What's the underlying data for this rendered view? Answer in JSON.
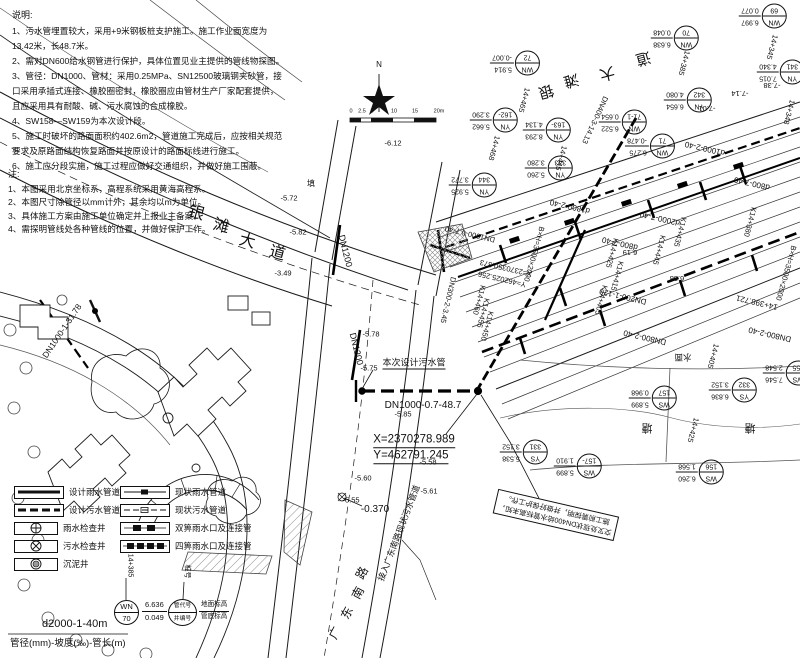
{
  "notes1": {
    "title": "说明:",
    "lines": [
      "1、污水管埋置较大，采用+9米钢板桩支护施工。施工作业面宽度为13.42米，长48.7米。",
      "2、需对DN600给水钢管进行保护，具体位置见业主提供的管线物探图。",
      "3、管径：DN1000、管材：采用0.25MPa、SN12500玻璃钢夹砂管，接口采用承插式连接、橡胶圈密封，橡胶圈应由管材生产厂家配套提供，且应采用具有耐酸、碱、污水腐蚀的合成橡胶。",
      "4、SW158—SW159为本次设计段。",
      "5、施工时破坏的路面面积约402.6m2，管道施工完成后，应按相关规范要求及原路面结构恢复路面并按原设计的路面标线进行施工。",
      "6、施工应分段实施，施工过程应做好交通组织，并做好施工围蔽。"
    ]
  },
  "notes2": {
    "title": "注:",
    "lines": [
      "1、本图采用北京坐标系，高程系统采用黄海高程系。",
      "2、本图尺寸除管径以mm计外，其余均以m为单位。",
      "3、具体施工方案由施工单位确定并上报业主备案。",
      "4、需探明管线处各种管线的位置，并做好保护工作。"
    ]
  },
  "legend": {
    "left": [
      {
        "label": "设计雨水管道"
      },
      {
        "label": "设计污水管道"
      },
      {
        "label": "雨水检查井"
      },
      {
        "label": "污水检查井"
      },
      {
        "label": "沉泥井"
      }
    ],
    "right": [
      {
        "label": "现状雨水管道"
      },
      {
        "label": "现状污水管道"
      },
      {
        "label": "双箅雨水口及连接管"
      },
      {
        "label": "四箅雨水口及连接管"
      }
    ]
  },
  "example": {
    "chainage": "14+385",
    "code": "WN",
    "num": "70",
    "v1": "6.636",
    "v2": "0.049",
    "chainage2_label": "桩号",
    "code_label": "管代号",
    "num_label": "井编号",
    "v1_label": "地面标高",
    "v2_label": "管底标高"
  },
  "footer": {
    "spec": "d2000-1-40m",
    "caption": "管径(mm)-坡度(‰)-管长(m)"
  },
  "note_box": {
    "line1": "交叉处现状DN400给水管标高未知，",
    "line2": "施工前需探明，并做好保护工作。"
  },
  "annotations": [
    {
      "t": "银",
      "x": 196,
      "y": 214,
      "r": 15,
      "s": 16
    },
    {
      "t": "滩",
      "x": 221,
      "y": 227,
      "r": 15,
      "s": 16
    },
    {
      "t": "大",
      "x": 247,
      "y": 242,
      "r": 15,
      "s": 16
    },
    {
      "t": "道",
      "x": 277,
      "y": 254,
      "r": 15,
      "s": 16
    },
    {
      "t": "银",
      "x": 546,
      "y": 91,
      "r": 165,
      "s": 15
    },
    {
      "t": "滩",
      "x": 571,
      "y": 80,
      "r": 165,
      "s": 15
    },
    {
      "t": "大",
      "x": 607,
      "y": 73,
      "r": 165,
      "s": 15
    },
    {
      "t": "道",
      "x": 643,
      "y": 58,
      "r": 165,
      "s": 15
    },
    {
      "t": "广",
      "x": 335,
      "y": 633,
      "r": -62,
      "s": 12
    },
    {
      "t": "东",
      "x": 347,
      "y": 613,
      "r": -62,
      "s": 12
    },
    {
      "t": "南",
      "x": 358,
      "y": 593,
      "r": -62,
      "s": 12
    },
    {
      "t": "路",
      "x": 362,
      "y": 573,
      "r": -62,
      "s": 12
    },
    {
      "t": "DN1200",
      "x": 345,
      "y": 251,
      "r": 76,
      "s": 9
    },
    {
      "t": "DN1200",
      "x": 356,
      "y": 349,
      "r": 76,
      "s": 9
    },
    {
      "t": "本次设计污水管",
      "x": 414,
      "y": 364,
      "r": 0,
      "s": 9,
      "u": 1
    },
    {
      "t": "DN1000-0.7-48.7",
      "x": 423,
      "y": 406,
      "r": 0,
      "s": 10
    },
    {
      "t": "X=2370278.989",
      "x": 414,
      "y": 441,
      "r": 0,
      "s": 11.5,
      "u": 1
    },
    {
      "t": "Y=462791.245",
      "x": 411,
      "y": 457,
      "r": 0,
      "s": 11.5,
      "u": 1
    },
    {
      "t": "DN1000-1-31.78",
      "x": 62,
      "y": 331,
      "r": -56,
      "s": 8.5
    },
    {
      "t": "-0.370",
      "x": 375,
      "y": 510,
      "r": 0,
      "s": 10
    },
    {
      "t": "接入广东南路现状污水管道",
      "x": 399,
      "y": 533,
      "r": -69,
      "s": 8.5
    },
    {
      "t": "-5.78",
      "x": 371,
      "y": 334,
      "s": 7.5
    },
    {
      "t": "-5.75",
      "x": 369,
      "y": 368,
      "s": 7.5
    },
    {
      "t": "-5.85",
      "x": 403,
      "y": 414,
      "s": 7.5
    },
    {
      "t": "-5.58",
      "x": 428,
      "y": 462,
      "s": 7.5
    },
    {
      "t": "-5.60",
      "x": 363,
      "y": 478,
      "s": 7.5
    },
    {
      "t": "-5.55",
      "x": 351,
      "y": 500,
      "s": 7.5
    },
    {
      "t": "-5.61",
      "x": 429,
      "y": 491,
      "s": 7.5
    },
    {
      "t": "-6.12",
      "x": 393,
      "y": 143,
      "s": 7.5
    },
    {
      "t": "-5.72",
      "x": 289,
      "y": 198,
      "s": 7.5
    },
    {
      "t": "-5.82",
      "x": 298,
      "y": 232,
      "s": 7.5
    },
    {
      "t": "-3.49",
      "x": 283,
      "y": 273,
      "s": 7.5
    },
    {
      "t": "填",
      "x": 311,
      "y": 184,
      "s": 8
    },
    {
      "t": "-7.14",
      "x": 740,
      "y": 93,
      "r": 180,
      "s": 7.5
    },
    {
      "t": "-7.01",
      "x": 707,
      "y": 108,
      "r": 180,
      "s": 7.5
    },
    {
      "t": "-7.38",
      "x": 772,
      "y": 85,
      "r": 180,
      "s": 7.5
    },
    {
      "t": "6.19",
      "x": 630,
      "y": 252,
      "r": 180,
      "s": 7.5
    },
    {
      "t": "6.38",
      "x": 677,
      "y": 278,
      "r": 180,
      "s": 7.5
    },
    {
      "t": "水面",
      "x": 683,
      "y": 357,
      "r": 180,
      "s": 8.5
    },
    {
      "t": "塘",
      "x": 647,
      "y": 427,
      "r": 180,
      "s": 11
    },
    {
      "t": "塘",
      "x": 750,
      "y": 427,
      "r": 180,
      "s": 11
    },
    {
      "t": "d1800-2-40",
      "x": 570,
      "y": 206,
      "r": 193,
      "s": 8
    },
    {
      "t": "d1000-2-40",
      "x": 705,
      "y": 148,
      "r": 193,
      "s": 8
    },
    {
      "t": "d800-7-40",
      "x": 752,
      "y": 183,
      "r": 193,
      "s": 8
    },
    {
      "t": "d800-7-40",
      "x": 620,
      "y": 243,
      "r": 193,
      "s": 8
    },
    {
      "t": "d2000-7-40",
      "x": 660,
      "y": 218,
      "r": 193,
      "s": 8
    },
    {
      "t": "DN800-2-40",
      "x": 645,
      "y": 337,
      "r": 193,
      "s": 8
    },
    {
      "t": "DN800-2-40",
      "x": 770,
      "y": 334,
      "r": 193,
      "s": 8
    },
    {
      "t": "DN200-1-120",
      "x": 623,
      "y": 296,
      "r": 193,
      "s": 8
    },
    {
      "t": "14+398.721",
      "x": 757,
      "y": 302,
      "r": 193,
      "s": 8
    },
    {
      "t": "DN1000-0.7-40",
      "x": 470,
      "y": 234,
      "r": 193,
      "s": 7.5
    },
    {
      "t": "X=2370350.373",
      "x": 506,
      "y": 268,
      "r": 193,
      "s": 7.5
    },
    {
      "t": "Y=462025.256",
      "x": 502,
      "y": 279,
      "r": 193,
      "s": 7.5
    },
    {
      "t": "B×H=3500×2000",
      "x": 534,
      "y": 254,
      "r": 106,
      "s": 7.5
    },
    {
      "t": "B×H=3500×2000",
      "x": 786,
      "y": 273,
      "r": 106,
      "s": 7.5
    },
    {
      "t": "DN300-2-3.45",
      "x": 448,
      "y": 300,
      "r": 103,
      "s": 7.5
    },
    {
      "t": "DN400-3-14.13",
      "x": 595,
      "y": 120,
      "r": 115,
      "s": 7.5
    },
    {
      "t": "14+465",
      "x": 524,
      "y": 100,
      "r": 105,
      "s": 7.5
    },
    {
      "t": "14+445",
      "x": 561,
      "y": 158,
      "r": 105,
      "s": 7.5
    },
    {
      "t": "14+385",
      "x": 684,
      "y": 63,
      "r": 105,
      "s": 7.5
    },
    {
      "t": "14+345",
      "x": 772,
      "y": 47,
      "r": 105,
      "s": 7.5
    },
    {
      "t": "14+348",
      "x": 789,
      "y": 112,
      "r": 105,
      "s": 7.5
    },
    {
      "t": "14+468",
      "x": 494,
      "y": 148,
      "r": 105,
      "s": 7.5
    },
    {
      "t": "14+425",
      "x": 693,
      "y": 430,
      "r": 105,
      "s": 7.5
    },
    {
      "t": "14+405",
      "x": 713,
      "y": 356,
      "r": 105,
      "s": 7.5
    },
    {
      "t": "K14+445",
      "x": 659,
      "y": 250,
      "r": 105,
      "s": 7.5
    },
    {
      "t": "K14+435",
      "x": 680,
      "y": 232,
      "r": 105,
      "s": 7.5
    },
    {
      "t": "K14+425",
      "x": 612,
      "y": 253,
      "r": 105,
      "s": 7.5
    },
    {
      "t": "K14+415",
      "x": 617,
      "y": 276,
      "r": 105,
      "s": 7.5
    },
    {
      "t": "K14+405",
      "x": 601,
      "y": 300,
      "r": 105,
      "s": 7.5
    },
    {
      "t": "K14+380",
      "x": 750,
      "y": 222,
      "r": 105,
      "s": 7.5
    },
    {
      "t": "K14+460",
      "x": 479,
      "y": 300,
      "r": 105,
      "s": 7.5
    },
    {
      "t": "K14+455",
      "x": 483,
      "y": 313,
      "r": 105,
      "s": 7.5
    },
    {
      "t": "K14+450",
      "x": 487,
      "y": 326,
      "r": 105,
      "s": 7.5
    },
    {
      "t": "0",
      "x": 351,
      "y": 112,
      "s": 5.5
    },
    {
      "t": "2.5",
      "x": 362,
      "y": 112,
      "s": 5.5
    },
    {
      "t": "5",
      "x": 372,
      "y": 112,
      "s": 5.5
    },
    {
      "t": "10",
      "x": 394,
      "y": 112,
      "s": 5.5
    },
    {
      "t": "15",
      "x": 415,
      "y": 112,
      "s": 5.5
    },
    {
      "t": "20m",
      "x": 439,
      "y": 112,
      "s": 5.5
    },
    {
      "t": "N",
      "x": 379,
      "y": 65,
      "s": 8
    }
  ],
  "manholes": [
    {
      "code": "WN",
      "num": "72",
      "v1": "5.914",
      "v2": "-0.007",
      "x": 515,
      "y": 63,
      "r": 180
    },
    {
      "code": "WN",
      "num": "70",
      "v1": "6.638",
      "v2": "0.048",
      "x": 675,
      "y": 38,
      "r": 180
    },
    {
      "code": "WN",
      "num": "69",
      "v1": "6.997",
      "v2": "0.077",
      "x": 763,
      "y": 16,
      "r": 180
    },
    {
      "code": "YN",
      "num": "341",
      "v1": "7.015",
      "v2": "4.340",
      "x": 781,
      "y": 72,
      "r": 180
    },
    {
      "code": "YN",
      "num": "342",
      "v1": "6.654",
      "v2": "4.080",
      "x": 688,
      "y": 100,
      "r": 180
    },
    {
      "code": "WN",
      "num": "71-1",
      "v1": "6.522",
      "v2": "0.654",
      "x": 623,
      "y": 122,
      "r": 180
    },
    {
      "code": "WN",
      "num": "71",
      "v1": "6.275",
      "v2": "-0.478",
      "x": 650,
      "y": 146,
      "r": 180
    },
    {
      "code": "YN",
      "num": "162-",
      "v1": "5.662",
      "v2": "3.290",
      "x": 494,
      "y": 120,
      "r": 180
    },
    {
      "code": "YN",
      "num": "163-",
      "v1": "8.293",
      "v2": "4.134",
      "x": 547,
      "y": 130,
      "r": 180
    },
    {
      "code": "YN",
      "num": "344",
      "v1": "5.925",
      "v2": "3.772",
      "x": 473,
      "y": 185,
      "r": 180
    },
    {
      "code": "YN",
      "num": "343",
      "v1": "5.260",
      "v2": "3.280",
      "x": 549,
      "y": 168,
      "r": 180
    },
    {
      "code": "WS",
      "num": "157-",
      "v1": "5.899",
      "v2": "1.910",
      "x": 578,
      "y": 466,
      "r": 180
    },
    {
      "code": "YS",
      "num": "331",
      "v1": "5.538",
      "v2": "3.152",
      "x": 524,
      "y": 452,
      "r": 180
    },
    {
      "code": "WS",
      "num": "157",
      "v1": "5.899",
      "v2": "0.968",
      "x": 653,
      "y": 398,
      "r": 180
    },
    {
      "code": "YS",
      "num": "332",
      "v1": "6.836",
      "v2": "3.152",
      "x": 733,
      "y": 390,
      "r": 180
    },
    {
      "code": "WS",
      "num": "155",
      "v1": "7.546",
      "v2": "2.548",
      "x": 787,
      "y": 373,
      "r": 180
    },
    {
      "code": "WS",
      "num": "156",
      "v1": "6.260",
      "v2": "1.568",
      "x": 700,
      "y": 472,
      "r": 180
    }
  ]
}
